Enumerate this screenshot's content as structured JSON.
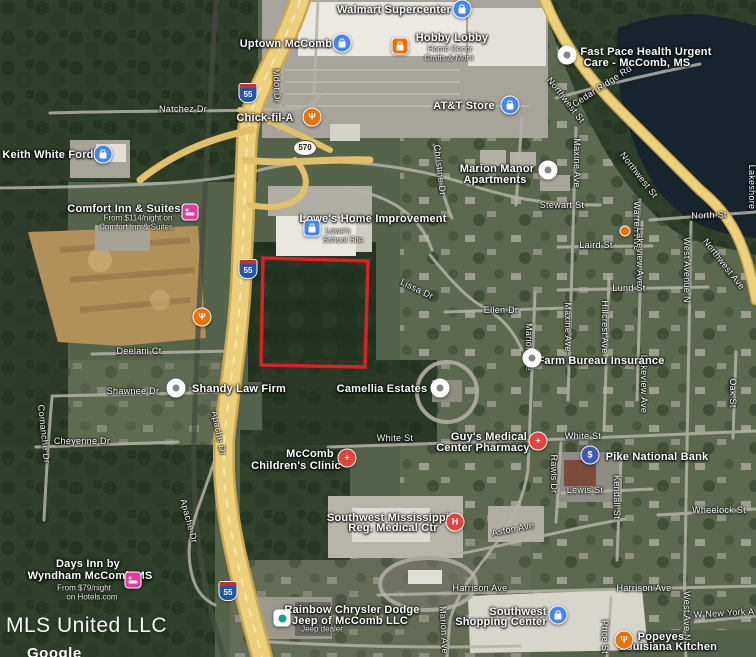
{
  "watermark": {
    "brand": "MLS United LLC"
  },
  "attribution": {
    "logo": "Google"
  },
  "parcel": {
    "stroke": "#dd2024",
    "points": "263,258 368,261 365,367 261,365"
  },
  "shields": [
    {
      "kind": "interstate",
      "text": "55",
      "x": 248,
      "y": 93
    },
    {
      "kind": "interstate",
      "text": "55",
      "x": 248,
      "y": 269
    },
    {
      "kind": "interstate",
      "text": "55",
      "x": 228,
      "y": 591
    },
    {
      "kind": "route",
      "text": "570",
      "x": 305,
      "y": 148
    }
  ],
  "pins": [
    {
      "name": "walmart-supercenter",
      "shape": "circle",
      "color": "#4285f4",
      "glyph": "bag",
      "x": 462,
      "y": 9
    },
    {
      "name": "uptown-mccomb",
      "shape": "circle",
      "color": "#4285f4",
      "glyph": "bag",
      "x": 342,
      "y": 43
    },
    {
      "name": "hobby-lobby",
      "shape": "square",
      "color": "#e8710a",
      "glyph": "bag",
      "x": 400,
      "y": 46
    },
    {
      "name": "fast-pace-health",
      "shape": "circle",
      "color": "#ffffff",
      "glyph": "dot",
      "x": 567,
      "y": 55
    },
    {
      "name": "chick-fil-a",
      "shape": "circle",
      "color": "#e8710a",
      "glyph": "fork",
      "x": 312,
      "y": 117
    },
    {
      "name": "att-store",
      "shape": "circle",
      "color": "#4285f4",
      "glyph": "bag",
      "x": 510,
      "y": 105
    },
    {
      "name": "keith-white-ford",
      "shape": "circle",
      "color": "#4285f4",
      "glyph": "bag",
      "x": 103,
      "y": 154
    },
    {
      "name": "marion-manor-apartments",
      "shape": "circle",
      "color": "#ffffff",
      "glyph": "dot",
      "x": 548,
      "y": 170
    },
    {
      "name": "comfort-inn",
      "shape": "square",
      "color": "#e23ba0",
      "glyph": "bed",
      "x": 190,
      "y": 212
    },
    {
      "name": "lowes-home-improvement",
      "shape": "square",
      "color": "#4285f4",
      "glyph": "bag",
      "x": 312,
      "y": 228
    },
    {
      "name": "restaurant-poi",
      "shape": "circle",
      "color": "#e8710a",
      "glyph": "fork",
      "x": 202,
      "y": 317
    },
    {
      "name": "poi-marker",
      "shape": "dot",
      "color": "#e8710a",
      "glyph": "",
      "x": 625,
      "y": 231
    },
    {
      "name": "farm-bureau-insurance",
      "shape": "circle",
      "color": "#ffffff",
      "glyph": "dot",
      "x": 532,
      "y": 358
    },
    {
      "name": "shandy-law-firm",
      "shape": "circle",
      "color": "#ffffff",
      "glyph": "dot",
      "x": 176,
      "y": 388
    },
    {
      "name": "camellia-estates",
      "shape": "circle",
      "color": "#ffffff",
      "glyph": "dot",
      "x": 440,
      "y": 388
    },
    {
      "name": "guys-medical-pharmacy",
      "shape": "circle",
      "color": "#df453b",
      "glyph": "cross",
      "x": 538,
      "y": 441
    },
    {
      "name": "pike-national-bank",
      "shape": "circle",
      "color": "#3c5bb5",
      "glyph": "dollar",
      "x": 590,
      "y": 455
    },
    {
      "name": "mccomb-childrens-clinic",
      "shape": "circle",
      "color": "#df453b",
      "glyph": "cross",
      "x": 347,
      "y": 458
    },
    {
      "name": "sw-regional-medical",
      "shape": "circle",
      "color": "#df453b",
      "glyph": "h",
      "x": 455,
      "y": 522
    },
    {
      "name": "days-inn",
      "shape": "square",
      "color": "#e23ba0",
      "glyph": "bed",
      "x": 133,
      "y": 580
    },
    {
      "name": "rainbow-chrysler-dealer",
      "shape": "square",
      "color": "#ffffff",
      "glyph": "store",
      "x": 282,
      "y": 618
    },
    {
      "name": "southwest-shopping-center",
      "shape": "circle",
      "color": "#4285f4",
      "glyph": "bag",
      "x": 558,
      "y": 615
    },
    {
      "name": "popeyes",
      "shape": "circle",
      "color": "#e8710a",
      "glyph": "fork",
      "x": 624,
      "y": 640
    }
  ],
  "place_labels": [
    {
      "text": "Walmart Supercenter",
      "x": 394,
      "y": 10
    },
    {
      "text": "Uptown McComb",
      "x": 286,
      "y": 44
    },
    {
      "text": "Hobby Lobby",
      "x": 452,
      "y": 38
    },
    {
      "text": "Home Decor",
      "x": 450,
      "y": 49,
      "sub": true
    },
    {
      "text": "Crafts & More",
      "x": 449,
      "y": 58,
      "sub": true
    },
    {
      "text": "Fast Pace Health Urgent",
      "x": 646,
      "y": 52
    },
    {
      "text": "Care - McComb, MS",
      "x": 637,
      "y": 63
    },
    {
      "text": "Keith White Ford",
      "x": 48,
      "y": 155
    },
    {
      "text": "Chick-fil-A",
      "x": 265,
      "y": 118
    },
    {
      "text": "AT&T Store",
      "x": 464,
      "y": 106
    },
    {
      "text": "Marion Manor",
      "x": 497,
      "y": 169
    },
    {
      "text": "Apartments",
      "x": 495,
      "y": 180
    },
    {
      "text": "Comfort Inn & Suites",
      "x": 124,
      "y": 209
    },
    {
      "text": "From $114/night on",
      "x": 138,
      "y": 218,
      "sub": true
    },
    {
      "text": "Comfort Inn & Suites",
      "x": 136,
      "y": 227,
      "sub": true
    },
    {
      "text": "Lowe's Home Improvement",
      "x": 373,
      "y": 219
    },
    {
      "text": "Lowe's",
      "x": 338,
      "y": 231,
      "sub": true
    },
    {
      "text": "School Site",
      "x": 343,
      "y": 240,
      "sub": true
    },
    {
      "text": "Shandy Law Firm",
      "x": 239,
      "y": 389
    },
    {
      "text": "Camellia Estates",
      "x": 382,
      "y": 389
    },
    {
      "text": "Farm Bureau Insurance",
      "x": 601,
      "y": 361
    },
    {
      "text": "Guy's Medical",
      "x": 489,
      "y": 437
    },
    {
      "text": "Center Pharmacy",
      "x": 483,
      "y": 448
    },
    {
      "text": "Pike National Bank",
      "x": 657,
      "y": 457
    },
    {
      "text": "McComb",
      "x": 310,
      "y": 454
    },
    {
      "text": "Children's Clinic",
      "x": 296,
      "y": 466
    },
    {
      "text": "Southwest Mississippi",
      "x": 388,
      "y": 518
    },
    {
      "text": "Reg. Medical Ctr",
      "x": 393,
      "y": 528
    },
    {
      "text": "Days Inn by",
      "x": 88,
      "y": 564
    },
    {
      "text": "Wyndham McComb MS",
      "x": 90,
      "y": 576
    },
    {
      "text": "From $79/night",
      "x": 84,
      "y": 588,
      "sub": true
    },
    {
      "text": "on Hotels.com",
      "x": 92,
      "y": 597,
      "sub": true
    },
    {
      "text": "Rainbow Chrysler Dodge",
      "x": 352,
      "y": 610
    },
    {
      "text": "Jeep of McComb LLC",
      "x": 350,
      "y": 621
    },
    {
      "text": "Jeep dealer",
      "x": 322,
      "y": 629,
      "sub": true
    },
    {
      "text": "Southwest",
      "x": 518,
      "y": 612
    },
    {
      "text": "Shopping Center",
      "x": 501,
      "y": 622
    },
    {
      "text": "Popeyes",
      "x": 661,
      "y": 637
    },
    {
      "text": "Louisiana Kitchen",
      "x": 668,
      "y": 647
    }
  ],
  "road_labels": [
    {
      "text": "Natchez Dr",
      "x": 183,
      "y": 109,
      "rot": 0
    },
    {
      "text": "Mdot Dr",
      "x": 277,
      "y": 86,
      "rot": 88
    },
    {
      "text": "Northwest St",
      "x": 566,
      "y": 100,
      "rot": 52
    },
    {
      "text": "Cedar Ridge Rd",
      "x": 602,
      "y": 86,
      "rot": -33
    },
    {
      "text": "Christine Dr",
      "x": 440,
      "y": 170,
      "rot": 83
    },
    {
      "text": "Maxine Ave",
      "x": 577,
      "y": 163,
      "rot": 90
    },
    {
      "text": "Northwest St",
      "x": 639,
      "y": 175,
      "rot": 52
    },
    {
      "text": "Stewart St",
      "x": 562,
      "y": 205,
      "rot": 0
    },
    {
      "text": "North St",
      "x": 709,
      "y": 215,
      "rot": -2
    },
    {
      "text": "Laird St",
      "x": 596,
      "y": 245,
      "rot": 0
    },
    {
      "text": "Warren Ave",
      "x": 637,
      "y": 226,
      "rot": 90
    },
    {
      "text": "Lakeview Ave",
      "x": 640,
      "y": 257,
      "rot": 90
    },
    {
      "text": "Lund St",
      "x": 629,
      "y": 288,
      "rot": 0
    },
    {
      "text": "West Avenue N",
      "x": 687,
      "y": 270,
      "rot": 90
    },
    {
      "text": "Northwest Ave",
      "x": 724,
      "y": 264,
      "rot": 52
    },
    {
      "text": "Lakeshore",
      "x": 752,
      "y": 187,
      "rot": 90
    },
    {
      "text": "Maxine Ave",
      "x": 568,
      "y": 327,
      "rot": 90
    },
    {
      "text": "Hillcrest Ave",
      "x": 605,
      "y": 327,
      "rot": 90
    },
    {
      "text": "Marion Ave",
      "x": 529,
      "y": 347,
      "rot": 90
    },
    {
      "text": "Ellen Dr",
      "x": 501,
      "y": 310,
      "rot": 0
    },
    {
      "text": "Lissa Dr",
      "x": 417,
      "y": 289,
      "rot": 26
    },
    {
      "text": "Oak St",
      "x": 733,
      "y": 393,
      "rot": 90
    },
    {
      "text": "Lakeview Ave",
      "x": 644,
      "y": 384,
      "rot": 90
    },
    {
      "text": "Deelani Ct",
      "x": 139,
      "y": 351,
      "rot": 0
    },
    {
      "text": "Shawnee Dr",
      "x": 133,
      "y": 391,
      "rot": 0
    },
    {
      "text": "Apache Dr",
      "x": 219,
      "y": 433,
      "rot": 78
    },
    {
      "text": "Comanche Dr",
      "x": 44,
      "y": 434,
      "rot": 84
    },
    {
      "text": "Cheyenne Dr",
      "x": 82,
      "y": 441,
      "rot": 0
    },
    {
      "text": "White St",
      "x": 395,
      "y": 438,
      "rot": 0
    },
    {
      "text": "White St",
      "x": 583,
      "y": 436,
      "rot": 0
    },
    {
      "text": "Rawls Dr",
      "x": 554,
      "y": 474,
      "rot": 90
    },
    {
      "text": "Lewis St",
      "x": 585,
      "y": 490,
      "rot": 0
    },
    {
      "text": "Kendall St",
      "x": 617,
      "y": 497,
      "rot": 90
    },
    {
      "text": "Wheelock St",
      "x": 719,
      "y": 510,
      "rot": 0
    },
    {
      "text": "Aston Ave",
      "x": 513,
      "y": 529,
      "rot": -11
    },
    {
      "text": "Apache Dr",
      "x": 189,
      "y": 521,
      "rot": 75
    },
    {
      "text": "Harrison Ave",
      "x": 480,
      "y": 588,
      "rot": 0
    },
    {
      "text": "Harrison Ave",
      "x": 644,
      "y": 588,
      "rot": 0
    },
    {
      "text": "Marion Ave",
      "x": 444,
      "y": 630,
      "rot": 87
    },
    {
      "text": "Price St",
      "x": 605,
      "y": 637,
      "rot": 90
    },
    {
      "text": "West Ave N",
      "x": 687,
      "y": 616,
      "rot": 90
    },
    {
      "text": "W New York A",
      "x": 724,
      "y": 613,
      "rot": -3
    }
  ]
}
